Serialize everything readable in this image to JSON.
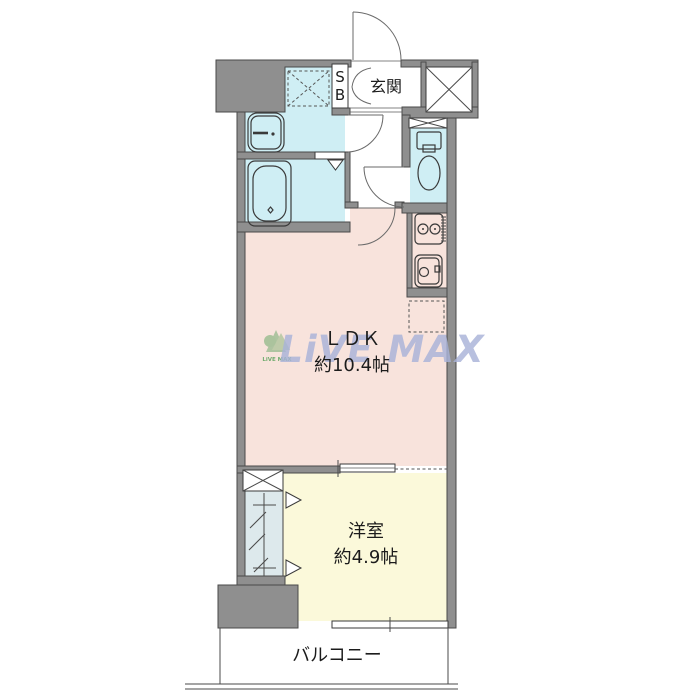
{
  "floor_plan": {
    "entrance": {
      "label": "玄関",
      "shoe_box_line1": "S",
      "shoe_box_line2": "B"
    },
    "ldk": {
      "label": "ＬＤＫ",
      "size": "約10.4帖"
    },
    "western_room": {
      "label": "洋室",
      "size": "約4.9帖"
    },
    "balcony": {
      "label": "バルコニー"
    },
    "watermark": {
      "text": "LiVE MAX"
    },
    "colors": {
      "wall": "#8f8f8f",
      "wet_area": "#cfeef4",
      "ldk_floor": "#f8e3dc",
      "western_room_floor": "#fbf9da",
      "closet_floor": "#dde9ec",
      "watermark_text": "#a9b3d9",
      "watermark_logo": "#57a05b"
    }
  }
}
